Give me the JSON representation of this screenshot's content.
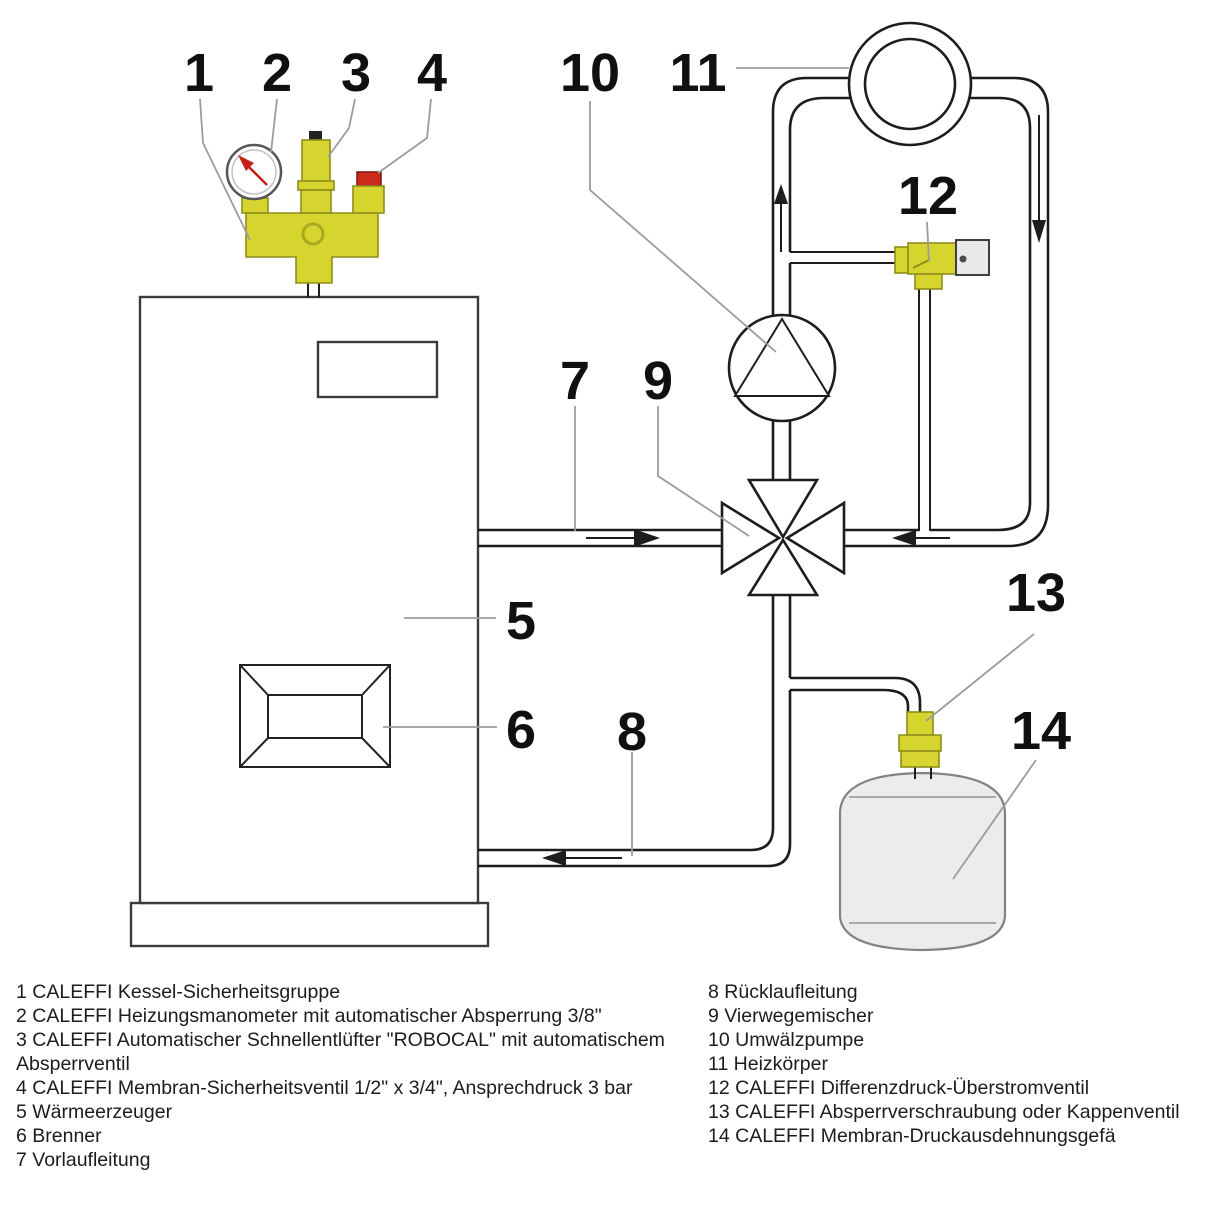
{
  "callouts": [
    {
      "label": "1"
    },
    {
      "label": "2"
    },
    {
      "label": "3"
    },
    {
      "label": "4"
    },
    {
      "label": "5"
    },
    {
      "label": "6"
    },
    {
      "label": "7"
    },
    {
      "label": "8"
    },
    {
      "label": "9"
    },
    {
      "label": "10"
    },
    {
      "label": "11"
    },
    {
      "label": "12"
    },
    {
      "label": "13"
    },
    {
      "label": "14"
    }
  ],
  "legend": {
    "left": [
      "1 CALEFFI Kessel-Sicherheitsgruppe",
      "2 CALEFFI Heizungsmanometer mit automatischer Absperrung 3/8\"",
      "3 CALEFFI Automatischer Schnellentlüfter \"ROBOCAL\" mit automatischem Absperrventil",
      "4 CALEFFI Membran-Sicherheitsventil 1/2\" x 3/4\", Ansprechdruck 3 bar",
      "5 Wärmeerzeuger",
      "6 Brenner",
      "7 Vorlaufleitung"
    ],
    "right": [
      "8 Rücklaufleitung",
      "9 Vierwegemischer",
      "10 Umwälzpumpe",
      "11 Heizkörper",
      "12 CALEFFI Differenzdruck-Überstromventil",
      "13 CALEFFI Absperrverschraubung oder Kappenventil",
      "14 CALEFFI Membran-Druckausdehnungsgefä"
    ]
  },
  "colors": {
    "brass": "#d6d52f",
    "brassDark": "#8e8d1c",
    "red": "#cd2a1e",
    "pipe": "#1d1d1d",
    "leader": "#9c9c9c",
    "tank": "#ececec"
  }
}
